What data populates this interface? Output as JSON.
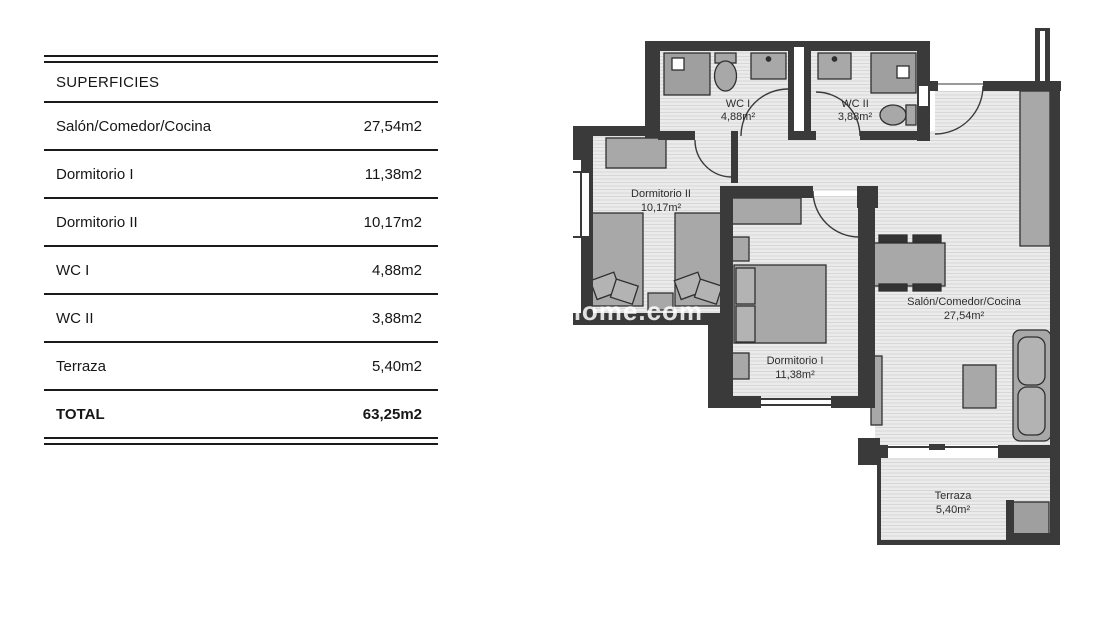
{
  "table": {
    "header": "SUPERFICIES",
    "rows": [
      {
        "label": "Salón/Comedor/Cocina",
        "value": "27,54m2"
      },
      {
        "label": "Dormitorio I",
        "value": "11,38m2"
      },
      {
        "label": "Dormitorio II",
        "value": "10,17m2"
      },
      {
        "label": "WC I",
        "value": "4,88m2"
      },
      {
        "label": "WC II",
        "value": "3,88m2"
      },
      {
        "label": "Terraza",
        "value": "5,40m2"
      }
    ],
    "total": {
      "label": "TOTAL",
      "value": "63,25m2"
    }
  },
  "plan": {
    "watermark": "home.com",
    "rooms": [
      {
        "name": "WC I",
        "area": "4,88m²"
      },
      {
        "name": "WC II",
        "area": "3,88m²"
      },
      {
        "name": "Dormitorio II",
        "area": "10,17m²"
      },
      {
        "name": "Dormitorio I",
        "area": "11,38m²"
      },
      {
        "name": "Salón/Comedor/Cocina",
        "area": "27,54m²"
      },
      {
        "name": "Terraza",
        "area": "5,40m²"
      }
    ],
    "colors": {
      "wall": "#3a3a3a",
      "floor": "#ebebeb",
      "furniture": "#a8a8a8"
    }
  }
}
